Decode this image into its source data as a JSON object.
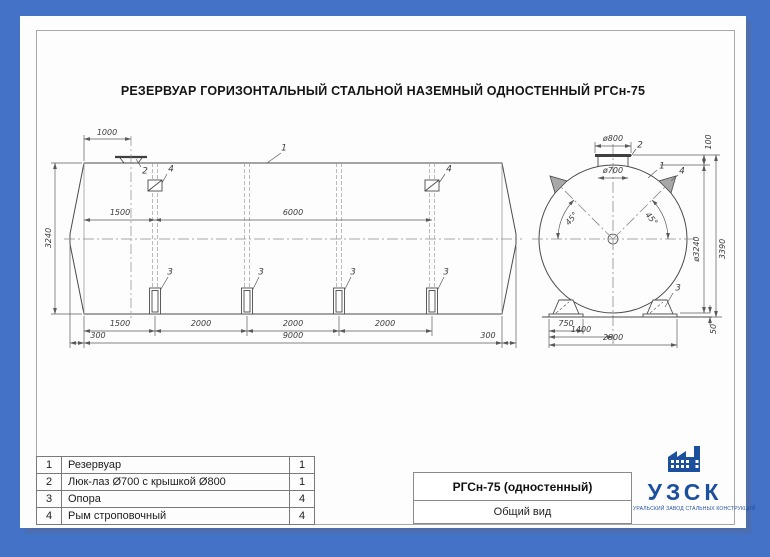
{
  "page": {
    "title": "РЕЗЕРВУАР ГОРИЗОНТАЛЬНЫЙ СТАЛЬНОЙ НАЗЕМНЫЙ ОДНОСТЕННЫЙ РГСн-75"
  },
  "side_view": {
    "dims": {
      "d1000": "1000",
      "d1500_top": "1500",
      "d6000": "6000",
      "d3240": "3240",
      "d1500_bot": "1500",
      "d2000_a": "2000",
      "d2000_b": "2000",
      "d2000_c": "2000",
      "d300_l": "300",
      "d9000": "9000",
      "d300_r": "300"
    },
    "callouts": {
      "c1": "1",
      "c2": "2",
      "c4l": "4",
      "c4r": "4",
      "c3a": "3",
      "c3b": "3",
      "c3c": "3",
      "c3d": "3"
    }
  },
  "end_view": {
    "dims": {
      "d800": "ø800",
      "d700": "ø700",
      "d100": "100",
      "d3240": "ø3240",
      "d3390": "3390",
      "a45l": "45°",
      "a45r": "45°",
      "d750": "750",
      "d1400": "1400",
      "d2800": "2800",
      "d50": "50"
    },
    "callouts": {
      "c1": "1",
      "c2": "2",
      "c4": "4",
      "c3": "3"
    }
  },
  "parts_table": {
    "rows": [
      {
        "pos": "1",
        "name": "Резервуар",
        "qty": "1"
      },
      {
        "pos": "2",
        "name": "Люк-лаз Ø700 с крышкой Ø800",
        "qty": "1"
      },
      {
        "pos": "3",
        "name": "Опора",
        "qty": "4"
      },
      {
        "pos": "4",
        "name": "Рым строповочный",
        "qty": "4"
      }
    ]
  },
  "title_block": {
    "model": "РГСн-75 (одностенный)",
    "view_name": "Общий вид"
  },
  "logo": {
    "abbr": "УЗСК",
    "tagline": "УРАЛЬСКИЙ ЗАВОД СТАЛЬНЫХ КОНСТРУКЦИЙ"
  }
}
